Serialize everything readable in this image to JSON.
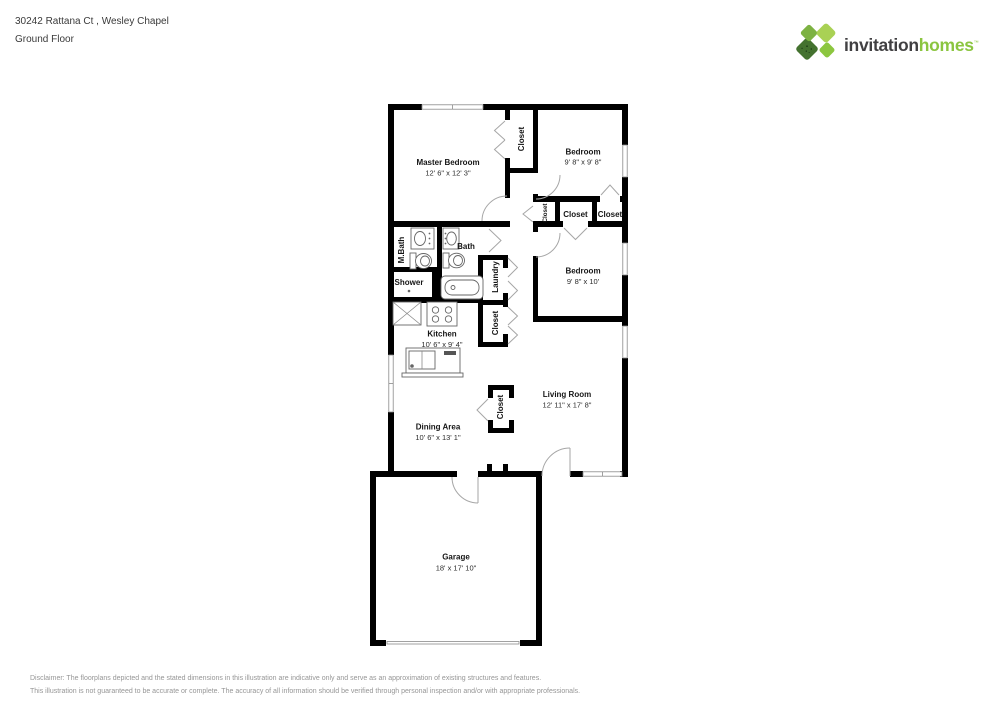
{
  "header": {
    "address": "30242 Rattana Ct , Wesley Chapel",
    "floor": "Ground Floor"
  },
  "logo": {
    "word1": "invitation",
    "word2": "homes",
    "trademark": "™",
    "colors": {
      "word1": "#414042",
      "word2": "#8bc540",
      "petal_nw": "#7db242",
      "petal_ne": "#a9d154",
      "petal_se": "#8cc63f",
      "petal_sw": "#44722f"
    }
  },
  "floorplan": {
    "rooms": {
      "master_bedroom": {
        "name": "Master Bedroom",
        "dims": "12' 6\" x 12' 3\""
      },
      "bedroom_top": {
        "name": "Bedroom",
        "dims": "9' 8\" x 9' 8\""
      },
      "bedroom_mid": {
        "name": "Bedroom",
        "dims": "9' 8\" x 10'"
      },
      "kitchen": {
        "name": "Kitchen",
        "dims": "10' 6\" x 9' 4\""
      },
      "dining_area": {
        "name": "Dining Area",
        "dims": "10' 6\" x 13' 1\""
      },
      "living_room": {
        "name": "Living Room",
        "dims": "12' 11\" x 17' 8\""
      },
      "garage": {
        "name": "Garage",
        "dims": "18' x 17' 10\""
      },
      "mbath": {
        "name": "M.Bath"
      },
      "bath": {
        "name": "Bath"
      },
      "shower": {
        "name": "Shower"
      },
      "laundry": {
        "name": "Laundry"
      },
      "closet_master": {
        "name": "Closet"
      },
      "closet_hall_small": {
        "name": "Closet"
      },
      "closet_bedroom_mid": {
        "name": "Closet"
      },
      "closet_bedroom_top": {
        "name": "Closet"
      },
      "closet_kitchen_hall": {
        "name": "Closet"
      },
      "closet_living": {
        "name": "Closet"
      }
    }
  },
  "disclaimer": {
    "line1": "Disclaimer: The floorplans depicted and the stated dimensions in this illustration are indicative only and serve as an approximation of existing structures and features.",
    "line2": "This illustration is not guaranteed to be accurate or complete. The accuracy of all information should be verified through personal inspection and/or with appropriate professionals."
  }
}
